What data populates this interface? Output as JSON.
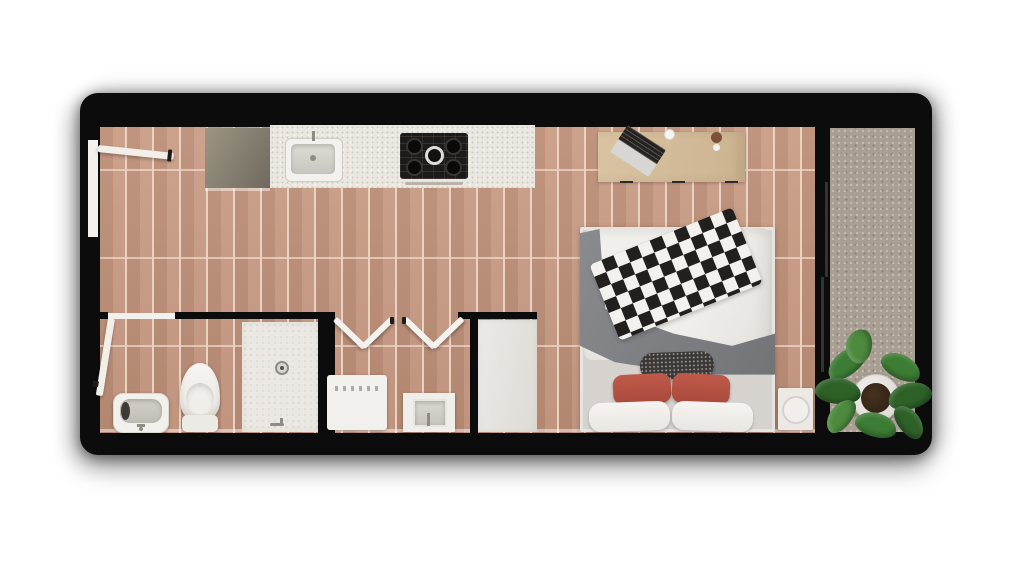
{
  "floorplan": {
    "kind": "studio-apartment-top-down-3d-render",
    "rooms": [
      {
        "id": "main-room",
        "fixtures": [
          "entry-door",
          "refrigerator",
          "kitchen-counter",
          "kitchen-sink",
          "gas-stove",
          "desk",
          "laptop",
          "cup",
          "desk-plant",
          "double-bed",
          "duvet",
          "plaid-throw-blanket",
          "gray-blanket",
          "red-accent-pillows",
          "white-pillows",
          "dark-lumbar-pillow",
          "nightstand"
        ]
      },
      {
        "id": "bathroom",
        "fixtures": [
          "bathroom-door",
          "washbasin",
          "toilet",
          "walk-in-shower",
          "shower-drain",
          "shower-faucet"
        ]
      },
      {
        "id": "laundry-closet",
        "fixtures": [
          "bifold-doors",
          "washing-machine",
          "utility-sink"
        ]
      },
      {
        "id": "closet",
        "fixtures": [
          "closet-door-panel"
        ]
      },
      {
        "id": "balcony",
        "fixtures": [
          "sliding-glass-door",
          "potted-plant"
        ]
      }
    ],
    "colors": {
      "wall": "#0c0c0c",
      "wood": "#c6957c",
      "wood-gap": "#e9d2c2",
      "balcony": "#a89e92",
      "counter": "#eae7e1",
      "fridge-a": "#9c9585",
      "fridge-b": "#6f6a5e",
      "desk": "#d9c3a2",
      "stove": "#1d1b1a",
      "white-fixture": "#f3f1ed",
      "platform": "#d6d3cf",
      "duvet": "#f1efec",
      "blanket": "#8a8b8f",
      "plaid-dark": "#22201f",
      "plaid-light": "#f3f1ee",
      "pillow-red": "#bf5a4a",
      "pillow-dark": "#3b3835",
      "tile": "#ebe8e3",
      "pot": "#e9e7e3",
      "soil": "#47321f",
      "leaf-a": "#3c7c34",
      "leaf-b": "#2e6128",
      "leaf-c": "#4c8a3e",
      "door-white": "#f2efeb"
    }
  }
}
